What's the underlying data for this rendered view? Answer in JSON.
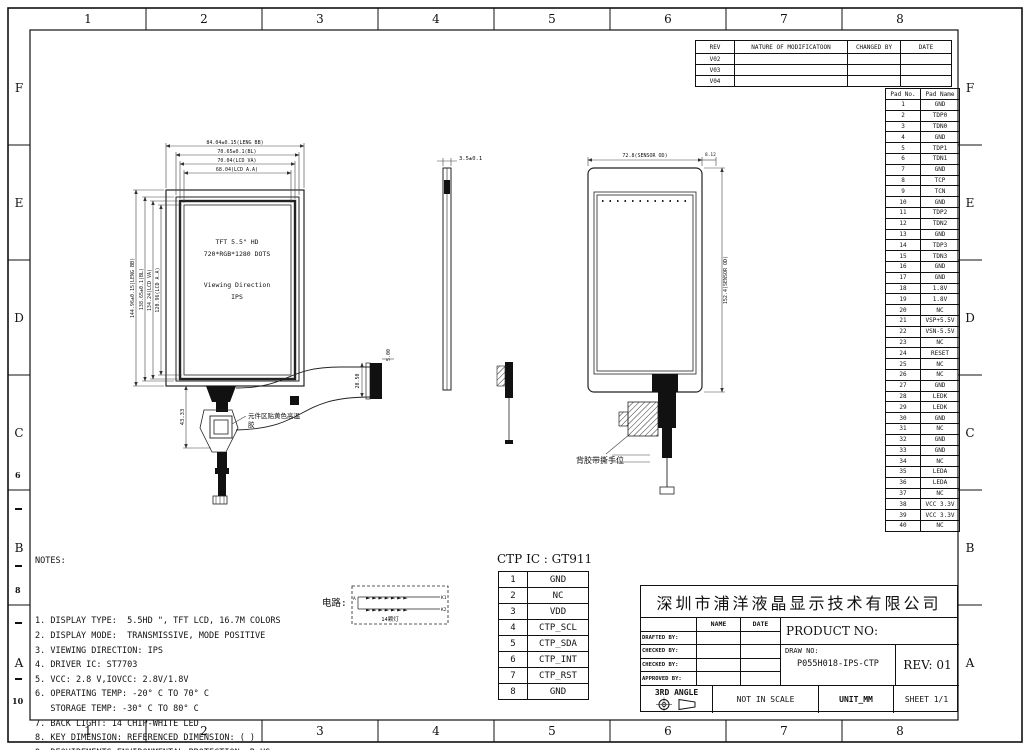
{
  "border": {
    "columns": [
      "1",
      "2",
      "3",
      "4",
      "5",
      "6",
      "7",
      "8"
    ],
    "rows": [
      "F",
      "E",
      "D",
      "C",
      "B",
      "A"
    ],
    "left_subticks": [
      "6",
      "8",
      "10"
    ]
  },
  "revision_table": {
    "headers": [
      "REV",
      "NATURE OF MODIFICATOON",
      "CHANGED BY",
      "DATE"
    ],
    "rows": [
      "V02",
      "V03",
      "V04"
    ]
  },
  "pad_table": {
    "headers": [
      "Pad No.",
      "Pad Name"
    ],
    "rows": [
      [
        "1",
        "GND"
      ],
      [
        "2",
        "TDP0"
      ],
      [
        "3",
        "TDN0"
      ],
      [
        "4",
        "GND"
      ],
      [
        "5",
        "TDP1"
      ],
      [
        "6",
        "TDN1"
      ],
      [
        "7",
        "GND"
      ],
      [
        "8",
        "TCP"
      ],
      [
        "9",
        "TCN"
      ],
      [
        "10",
        "GND"
      ],
      [
        "11",
        "TDP2"
      ],
      [
        "12",
        "TDN2"
      ],
      [
        "13",
        "GND"
      ],
      [
        "14",
        "TDP3"
      ],
      [
        "15",
        "TDN3"
      ],
      [
        "16",
        "GND"
      ],
      [
        "17",
        "GND"
      ],
      [
        "18",
        "1.8V"
      ],
      [
        "19",
        "1.8V"
      ],
      [
        "20",
        "NC"
      ],
      [
        "21",
        "VSP+5.5V"
      ],
      [
        "22",
        "VSN-5.5V"
      ],
      [
        "23",
        "NC"
      ],
      [
        "24",
        "RESET"
      ],
      [
        "25",
        "NC"
      ],
      [
        "26",
        "NC"
      ],
      [
        "27",
        "GND"
      ],
      [
        "28",
        "LEDK"
      ],
      [
        "29",
        "LEDK"
      ],
      [
        "30",
        "GND"
      ],
      [
        "31",
        "NC"
      ],
      [
        "32",
        "GND"
      ],
      [
        "33",
        "GND"
      ],
      [
        "34",
        "NC"
      ],
      [
        "35",
        "LEDA"
      ],
      [
        "36",
        "LEDA"
      ],
      [
        "37",
        "NC"
      ],
      [
        "38",
        "VCC 3.3V"
      ],
      [
        "39",
        "VCC 3.3V"
      ],
      [
        "40",
        "NC"
      ]
    ]
  },
  "notes": {
    "title": "NOTES:",
    "items": [
      "1. DISPLAY TYPE:  5.5HD \", TFT LCD, 16.7M COLORS",
      "2. DISPLAY MODE:  TRANSMISSIVE, MODE POSITIVE",
      "3. VIEWING DIRECTION: IPS",
      "4. DRIVER IC: ST7703",
      "5. VCC: 2.8 V,IOVCC: 2.8V/1.8V",
      "6. OPERATING TEMP: -20° C TO 70° C",
      "   STORAGE TEMP: -30° C TO 80° C",
      "7. BACK LIGHT: 14 CHIP-WHITE LED",
      "8. KEY DIMENSION: REFERENCED DIMENSION: ( )",
      "9. REQUIREMENTS ENVIRONMENTAL PROTECTION: RoHS"
    ]
  },
  "ctp": {
    "title": "CTP IC : GT911",
    "rows": [
      [
        "1",
        "GND"
      ],
      [
        "2",
        "NC"
      ],
      [
        "3",
        "VDD"
      ],
      [
        "4",
        "CTP_SCL"
      ],
      [
        "5",
        "CTP_SDA"
      ],
      [
        "6",
        "CTP_INT"
      ],
      [
        "7",
        "CTP_RST"
      ],
      [
        "8",
        "GND"
      ]
    ]
  },
  "circuit": {
    "label": "电路:",
    "caption": "14颗灯",
    "anode": "A",
    "k1": "K1",
    "k2": "K2",
    "led_row": "►►►►►►►"
  },
  "title_block": {
    "company": "深圳市浦洋液晶显示技术有限公司",
    "name_header": "NAME",
    "date_header": "DATE",
    "sig_rows": [
      "DRAFTED BY:",
      "CHECKED BY:",
      "CHECKED BY:",
      "APPROVED BY:"
    ],
    "product_no_label": "PRODUCT NO:",
    "draw_no_label": "DRAW NO:",
    "draw_no_value": "P055H018-IPS-CTP",
    "rev": "REV: 01",
    "angle": "3RD ANGLE",
    "scale": "NOT IN SCALE",
    "unit": "UNIT_MM",
    "sheet": "SHEET 1/1"
  },
  "lcd_view": {
    "dims_top": [
      "84.04±0.15(LENG BB)",
      "70.65±0.1(BL)",
      "70.04(LCD VA)",
      "68.04(LCD A.A)"
    ],
    "dims_left": [
      "144.96±0.15(LENG BB)",
      "138.65±0.1(BL)",
      "134.24(LCD VA)",
      "120.96(LCD A.A)"
    ],
    "center_lines": [
      "TFT 5.5\" HD",
      "720*RGB*1280 DOTS",
      "Viewing Direction",
      "IPS"
    ],
    "fpc_dim": "43.33",
    "fpc_note_1": "元件区贴黄色高温",
    "fpc_note_2": "胶",
    "cable_dim_width": "5.00",
    "cable_dim_height": "20.50"
  },
  "side_view": {
    "thickness_dim": "3.5±0.1"
  },
  "ctp_view": {
    "width_dim": "72.8(SENSOR OD)",
    "edge_dim": "8.12",
    "height_dim": "152.4(SENSOR OD)",
    "pull_tab_note": "背胶带撕手位"
  }
}
